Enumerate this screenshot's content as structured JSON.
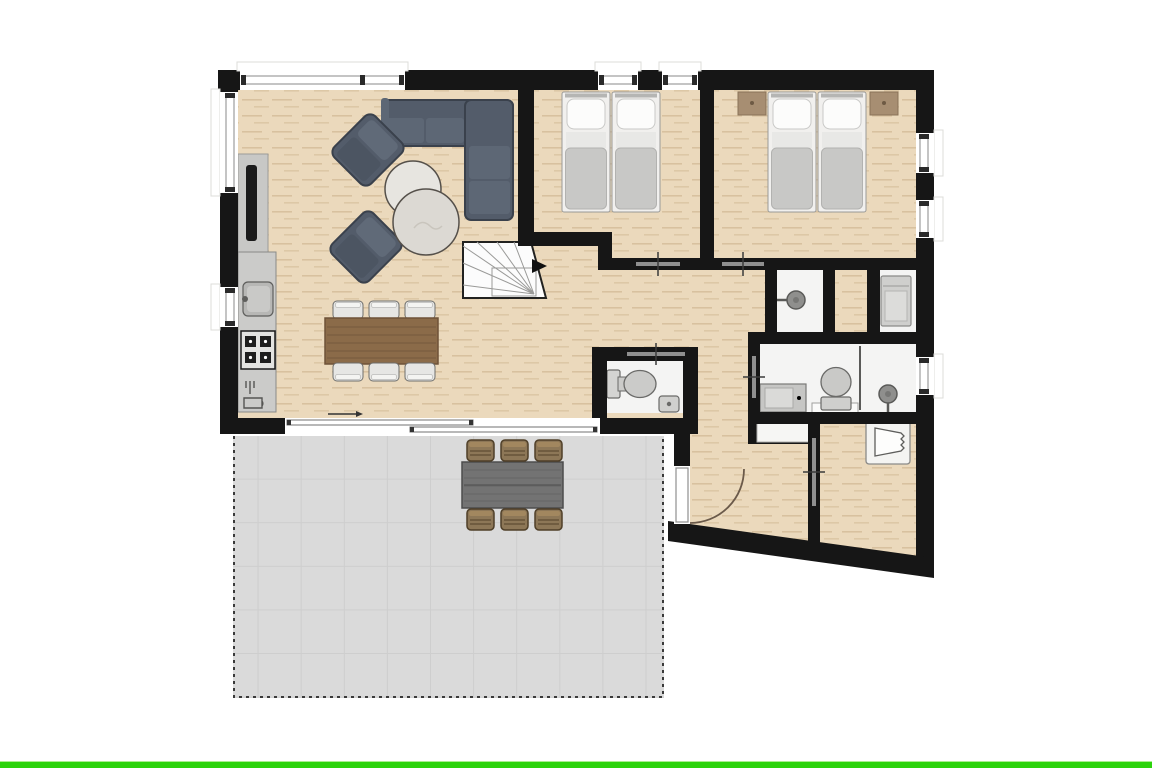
{
  "canvas": {
    "width": 1152,
    "height": 768,
    "background": "#ffffff"
  },
  "bottom_bar": {
    "color": "#2bd30b"
  },
  "palette": {
    "wall": "#161616",
    "wood_floor": "#ebd9bc",
    "wet_room_floor": "#f4f4f3",
    "terrace_floor": "#dadada",
    "upholstery": "#535c6a",
    "dining_table_wood": "#8b6b49",
    "outdoor_wicker": "#8d7757",
    "door_swing_arc": "#6b5a4a",
    "nightstand_wood": "#a78e72"
  },
  "floor_plan": {
    "title": "apartment-ground-floor-plan",
    "rooms": [
      {
        "name": "living-room",
        "floor": "wood",
        "furniture": [
          "corner-sofa",
          "armchair",
          "armchair",
          "round-coffee-table",
          "round-coffee-table",
          "tv-panel"
        ]
      },
      {
        "name": "kitchen",
        "floor": "wood",
        "fixtures": [
          "sink",
          "stove-4-burner",
          "dishwasher"
        ]
      },
      {
        "name": "dining-area",
        "floor": "wood",
        "furniture": [
          "dining-table",
          "dining-chair",
          "dining-chair",
          "dining-chair",
          "dining-chair",
          "dining-chair",
          "dining-chair"
        ]
      },
      {
        "name": "bedroom-1",
        "floor": "wood",
        "furniture": [
          "single-bed",
          "single-bed"
        ]
      },
      {
        "name": "bedroom-2",
        "floor": "wood",
        "furniture": [
          "single-bed",
          "single-bed",
          "nightstand",
          "nightstand"
        ]
      },
      {
        "name": "hallway",
        "floor": "wood",
        "furniture": []
      },
      {
        "name": "staircase",
        "floor": "white",
        "treads": "winder-fan",
        "direction_arrow": "right"
      },
      {
        "name": "wc",
        "floor": "tile",
        "fixtures": [
          "toilet",
          "corner-hand-basin"
        ]
      },
      {
        "name": "shower-room",
        "floor": "tile",
        "fixtures": [
          "shower-head"
        ]
      },
      {
        "name": "bathroom",
        "floor": "tile",
        "fixtures": [
          "vanity-sink",
          "toilet",
          "glass-screen",
          "shower-head"
        ]
      },
      {
        "name": "laundry-niche",
        "floor": "tile",
        "fixtures": [
          "washing-machine"
        ]
      },
      {
        "name": "entry-hall",
        "floor": "wood",
        "fixtures": [
          "closet-nook"
        ]
      },
      {
        "name": "storage-room",
        "floor": "wood",
        "furniture": [
          "wardrobe"
        ]
      },
      {
        "name": "terrace",
        "floor": "tile-grid",
        "border": "dashed",
        "furniture": [
          "outdoor-table",
          "outdoor-chair",
          "outdoor-chair",
          "outdoor-chair",
          "outdoor-chair",
          "outdoor-chair",
          "outdoor-chair"
        ]
      }
    ],
    "doors": [
      {
        "name": "front-door",
        "type": "swing",
        "location": "entry-hall-west"
      },
      {
        "name": "terrace-sliding-door",
        "type": "sliding",
        "location": "living-room-south",
        "arrow": "right"
      },
      {
        "name": "bedroom-1-door",
        "type": "interior",
        "location": "hall-wall"
      },
      {
        "name": "bedroom-2-door",
        "type": "interior",
        "location": "hall-wall"
      },
      {
        "name": "wc-door",
        "type": "interior",
        "location": "wc-north"
      },
      {
        "name": "bathroom-door",
        "type": "interior",
        "location": "bathroom-west"
      },
      {
        "name": "storage-room-door",
        "type": "interior",
        "location": "storage-west"
      }
    ],
    "windows": [
      {
        "name": "living-room-north-window",
        "wall": "north",
        "mullions": 3
      },
      {
        "name": "bedroom-1-north-window-a",
        "wall": "north",
        "mullions": 2
      },
      {
        "name": "bedroom-1-north-window-b",
        "wall": "north",
        "mullions": 2
      },
      {
        "name": "living-room-west-window",
        "wall": "west",
        "mullions": 2
      },
      {
        "name": "kitchen-west-window",
        "wall": "west",
        "mullions": 2
      },
      {
        "name": "bedroom-2-east-window-a",
        "wall": "east",
        "mullions": 2
      },
      {
        "name": "bedroom-2-east-window-b",
        "wall": "east",
        "mullions": 2
      },
      {
        "name": "bathroom-east-window",
        "wall": "east",
        "mullions": 2
      }
    ],
    "counts": {
      "bedrooms": 2,
      "beds": 4,
      "dining_chairs": 6,
      "outdoor_chairs": 6,
      "toilets": 2,
      "shower_heads": 2
    }
  }
}
